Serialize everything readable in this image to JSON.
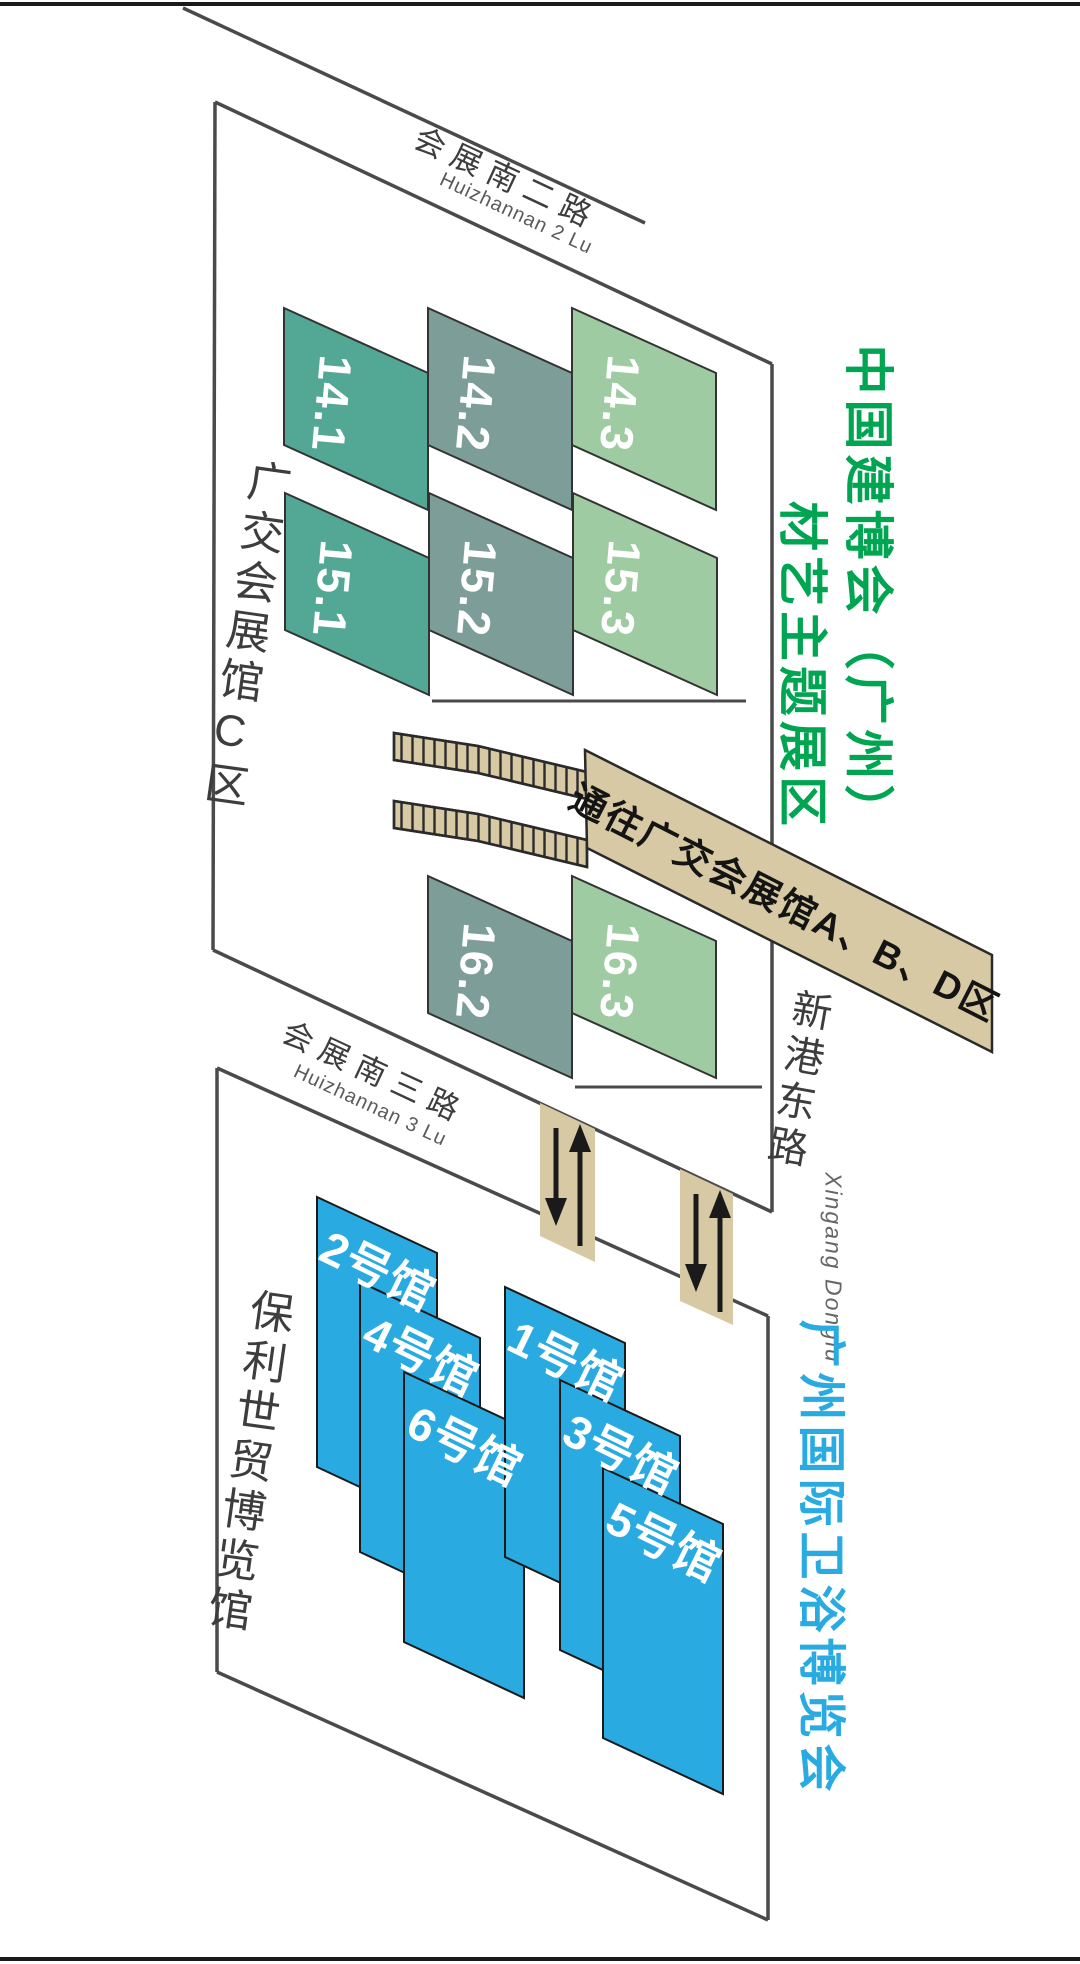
{
  "palette": {
    "teal": "#52A894",
    "gray_green": "#7C9D98",
    "light_green": "#9FCBA2",
    "hall_blue": "#29ABE2",
    "tan": "#D6C9A3",
    "green_title": "#00A551",
    "blue_title": "#29ABE2",
    "line": "#4A4A4A",
    "text_dark": "#3D3D3D"
  },
  "titles": {
    "expo_green_line1": "中国建博会（广州）",
    "expo_green_line2": "材艺主题展区",
    "expo_blue": "广州国际卫浴博览会"
  },
  "areas": {
    "canton_c": "广交会展馆C区",
    "poly_world_trade": "保利世贸博览馆"
  },
  "roads": {
    "huizhannan2": {
      "cn": "会展南二路",
      "en": "Huizhannan 2 Lu"
    },
    "huizhannan3": {
      "cn": "会展南三路",
      "en": "Huizhannan 3 Lu"
    },
    "xingang": {
      "cn": "新港东路",
      "en": "Xingang Donglu"
    }
  },
  "banner": {
    "text": "通往广交会展馆A、B、D区"
  },
  "green_halls": [
    {
      "label": "14.1",
      "color": "#52A894"
    },
    {
      "label": "14.2",
      "color": "#7C9D98"
    },
    {
      "label": "14.3",
      "color": "#9FCBA2"
    },
    {
      "label": "15.1",
      "color": "#52A894"
    },
    {
      "label": "15.2",
      "color": "#7C9D98"
    },
    {
      "label": "15.3",
      "color": "#9FCBA2"
    },
    {
      "label": "16.2",
      "color": "#7C9D98"
    },
    {
      "label": "16.3",
      "color": "#9FCBA2"
    }
  ],
  "blue_halls": [
    {
      "label": "2号馆",
      "color": "#29ABE2"
    },
    {
      "label": "4号馆",
      "color": "#29ABE2"
    },
    {
      "label": "6号馆",
      "color": "#29ABE2"
    },
    {
      "label": "1号馆",
      "color": "#29ABE2"
    },
    {
      "label": "3号馆",
      "color": "#29ABE2"
    },
    {
      "label": "5号馆",
      "color": "#29ABE2"
    }
  ]
}
